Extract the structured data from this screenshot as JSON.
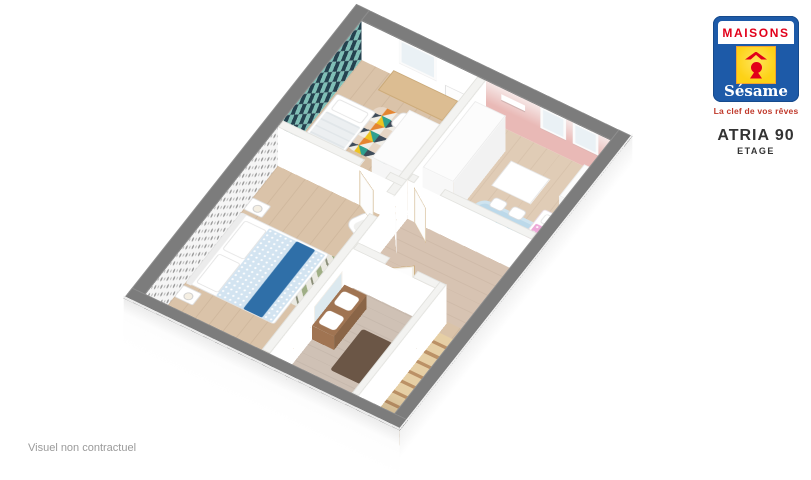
{
  "header": {
    "model": "ATRIA 90",
    "level": "ETAGE"
  },
  "branding": {
    "maisons": "MAISONS",
    "sesame": "Sésame",
    "tagline": "La clef de vos rêves"
  },
  "footer": {
    "disclaimer": "Visuel non contractuel"
  },
  "floorplan": {
    "view": "3d-isometric-cutaway",
    "rooms": [
      "bedroom-teal",
      "bedroom-pink",
      "bedroom-master",
      "bathroom",
      "landing",
      "staircase"
    ]
  },
  "colors": {
    "page_bg": "#ffffff",
    "wall_top": "#7c7c7c",
    "wall_top_edge": "#909090",
    "int_wall_top": "#f3f3f1",
    "wall_face": "#ffffff",
    "floor_wood": "#dac3a9",
    "floor_pink_room": "#e0ccb6",
    "floor_hall": "#d7c3b2",
    "floor_bath": "#cfc1b5",
    "teal_a": "#24424f",
    "teal_b": "#7fbfb6",
    "teal_bg": "#eef7f4",
    "gray_dot": "#9b9b9b",
    "gray_bg": "#f5f5f5",
    "pink_wall": "#e9b9b6",
    "pink_wall_light": "#f6e8e7",
    "pink_bed": "#eda9d8",
    "rug_blue": "#bcd9ea",
    "owl": "#3aa8d8",
    "teddy": "#9aa2ac",
    "duvet": "#d3e4f1",
    "runner": "#2f6fa8",
    "chevron_a": "#9fae85",
    "chevron_b": "#eae9e1",
    "rug_multi_a": "#e67e22",
    "rug_multi_b": "#1a9c8c",
    "rug_multi_c": "#f1c40f",
    "rug_multi_d": "#f3f3ee",
    "rug_multi_e": "#2c3e50",
    "stair_a": "#e6cfa5",
    "stair_b": "#bb9166",
    "vanity": "#a07452",
    "vanity_dark": "#8a6547",
    "mirror": "#dce9ef",
    "dark_rug": "#6b5646",
    "black_item": "#35302b",
    "tub_inner": "#d9dee1",
    "wood_edge": "#c9a876",
    "glass": "#eaf1f5",
    "logo_blue": "#1d5aa8",
    "logo_red": "#e2001a",
    "logo_yellow": "#fdd216",
    "yellow_edge": "#f0a230",
    "tagline": "#c0392b",
    "text_dark": "#333333",
    "text_gray": "#9a9a9a"
  }
}
